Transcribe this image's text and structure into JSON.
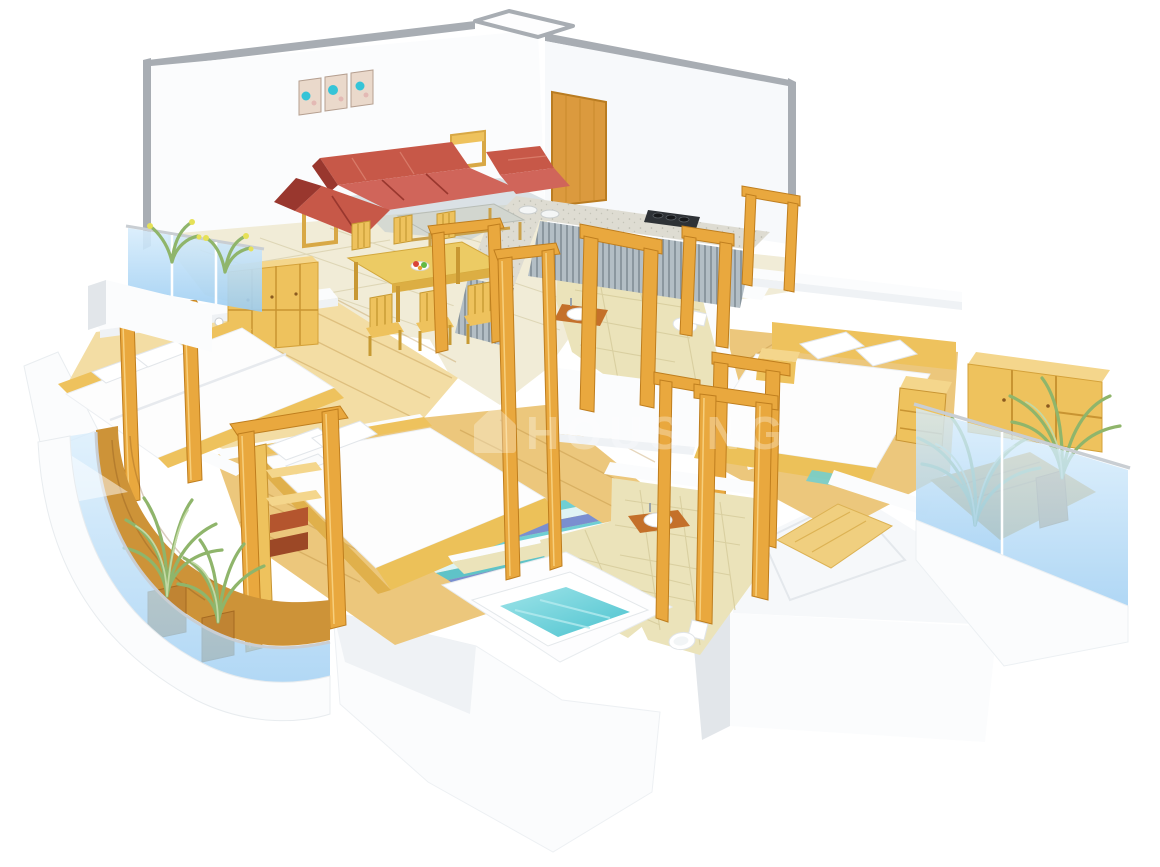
{
  "scene": {
    "type": "3d-isometric-floor-plan-render",
    "description": "3D cutaway floor plan of a 3-bedroom apartment with balconies",
    "background": "#ffffff"
  },
  "watermark": {
    "text": "HOUSING",
    "icon": "house-icon",
    "color": "#ffffff",
    "opacity": 0.3
  },
  "rooms": [
    {
      "id": "living-dining",
      "items": [
        "wall-art-triptych",
        "red-sofa-set",
        "armchair",
        "coffee-table",
        "side-tables",
        "dining-table",
        "dining-chairs",
        "fruit-plate"
      ]
    },
    {
      "id": "kitchen",
      "items": [
        "l-shaped-marble-counter",
        "steel-cabinet-fronts",
        "gas-stove",
        "double-sink",
        "wooden-door"
      ]
    },
    {
      "id": "bedroom-left",
      "items": [
        "double-bed",
        "pillows",
        "wardrobe",
        "wall-shelf",
        "open-wood-frame"
      ]
    },
    {
      "id": "bedroom-middle",
      "items": [
        "double-bed",
        "pillows",
        "striped-rug",
        "shelf-unit-with-drawers",
        "open-wood-frame"
      ]
    },
    {
      "id": "bedroom-right",
      "items": [
        "double-bed",
        "pillows",
        "bedside-tables",
        "wardrobe",
        "open-wood-frame"
      ]
    },
    {
      "id": "bathroom-upper",
      "items": [
        "washbasin-orange-counter",
        "toilet",
        "beige-tiles"
      ]
    },
    {
      "id": "bathroom-lower",
      "items": [
        "bathtub-with-water",
        "washbasin-orange-counter",
        "toilet",
        "beige-tiles",
        "wood-walkway"
      ]
    },
    {
      "id": "balcony-top-left",
      "items": [
        "blue-glass-railing",
        "flower-planter"
      ]
    },
    {
      "id": "balcony-curved-left",
      "items": [
        "blue-glass-railing",
        "wood-deck",
        "palm-plants",
        "wood-planter-pots"
      ]
    },
    {
      "id": "balcony-right",
      "items": [
        "blue-glass-railing",
        "wood-deck",
        "palm-plants",
        "wood-planter-box"
      ]
    }
  ],
  "palette": {
    "wallWhite": "#fbfcfd",
    "wallShade": "#eff2f5",
    "wallDark": "#e2e6ea",
    "wallEdge": "#a8adb3",
    "floorCream": "#f1ecd7",
    "floorCreamLine": "#ded6b6",
    "woodLight": "#f3dda4",
    "woodMid": "#ecc77c",
    "deck": "#cd9338",
    "furnWood": "#eec25d",
    "furnWoodDark": "#c89432",
    "furnWoodTop": "#f4d68c",
    "frameWood": "#e9a83e",
    "frameWoodDark": "#bf7e1e",
    "frameWoodHi": "#f7cf7c",
    "bedWhite": "#fdfdfd",
    "bedShade": "#e7eaee",
    "sofaRed": "#c75848",
    "sofaRedLight": "#d0655a",
    "sofaRedDark": "#99372e",
    "marble": "#dedcd2",
    "steel": "#b3bec5",
    "steelLine": "#8b979f",
    "stove": "#2e3236",
    "glass": "#a5d2f3",
    "glassHi": "#d6ecfc",
    "rail": "#c9ced3",
    "water": "#62ccd6",
    "waterHi": "#b5ebef",
    "bathTile": "#ebe3ba",
    "bathTileLine": "#d9cfa0",
    "plant": "#8fb56b",
    "plantHi": "#c3d9a4",
    "pot": "#c08433",
    "counterOrange": "#c4702a",
    "doorWood": "#db9a3e",
    "rugTeal": "#6fcfd4",
    "rugBlue": "#7a8fd0",
    "rugPale": "#dff4f5",
    "artTeal": "#35c4d7",
    "artPink": "#e3b9b4"
  }
}
